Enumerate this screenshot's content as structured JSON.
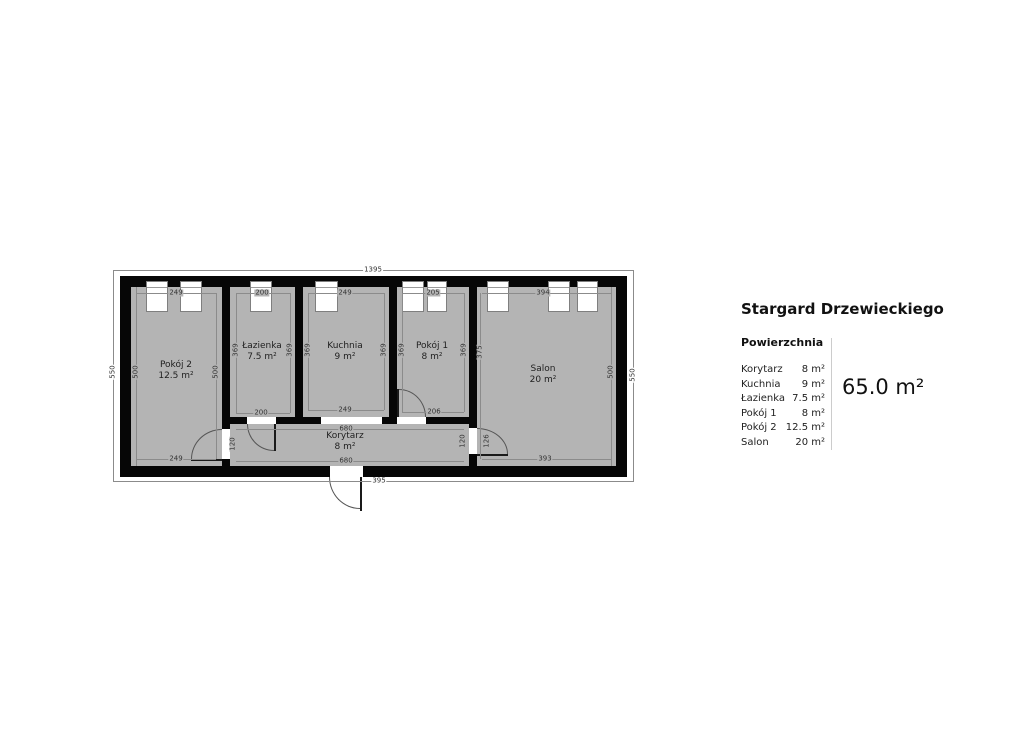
{
  "panel": {
    "title": "Stargard Drzewieckiego",
    "section_label": "Powierzchnia",
    "rows": [
      {
        "name": "Korytarz",
        "area": "8 m²"
      },
      {
        "name": "Kuchnia",
        "area": "9 m²"
      },
      {
        "name": "Łazienka",
        "area": "7.5 m²"
      },
      {
        "name": "Pokój 1",
        "area": "8 m²"
      },
      {
        "name": "Pokój 2",
        "area": "12.5 m²"
      },
      {
        "name": "Salon",
        "area": "20 m²"
      }
    ],
    "total_area": "65.0 m²"
  },
  "plan": {
    "rooms": [
      {
        "name": "Pokój 2",
        "area": "12.5 m²"
      },
      {
        "name": "Łazienka",
        "area": "7.5 m²"
      },
      {
        "name": "Kuchnia",
        "area": "9 m²"
      },
      {
        "name": "Pokój 1",
        "area": "8 m²"
      },
      {
        "name": "Salon",
        "area": "20 m²"
      },
      {
        "name": "Korytarz",
        "area": "8 m²"
      }
    ],
    "dims": {
      "overall_top": "1395",
      "overall_bottom": "395",
      "outer_left": "550",
      "outer_right": "550",
      "inner_left": "500",
      "inner_right": "500",
      "top_pokoj2": "249",
      "top_lazienka": "200",
      "top_kuchnia": "249",
      "top_pokoj1": "205",
      "top_salon": "394",
      "v_pokoj2_right": "500",
      "v_lazienka_left": "369",
      "v_lazienka_right": "369",
      "v_kuchnia_left": "369",
      "v_kuchnia_right": "369",
      "v_pokoj1_left": "369",
      "v_pokoj1_right": "369",
      "v_salon_left": "375",
      "bottom_pokoj2": "249",
      "bottom_lazienka": "200",
      "bottom_kuchnia": "249",
      "door_pokoj1": "206",
      "korytarz_top": "680",
      "korytarz_bottom": "680",
      "door_pokoj2": "120",
      "door_salon_a": "120",
      "door_salon_b": "126",
      "bottom_salon": "393"
    }
  },
  "colors": {
    "wall": "#060606",
    "floor": "#b4b4b4",
    "dim_line": "#8b8b8b",
    "divider": "#cccccc"
  }
}
